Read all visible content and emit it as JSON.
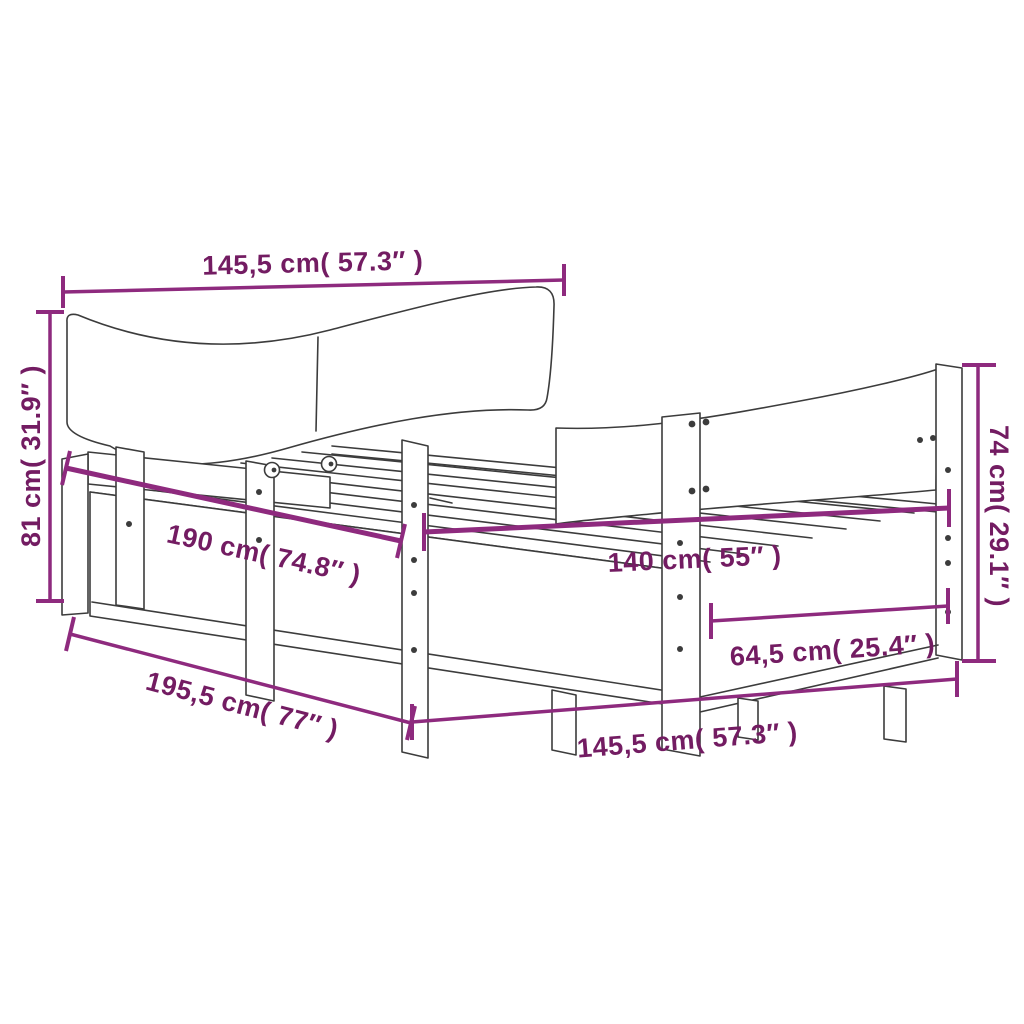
{
  "figure": {
    "title": "Bed frame with curved headboard and footboard - dimension diagram"
  },
  "colors": {
    "dimension_line": "#8E2A7E",
    "dimension_text": "#731C62",
    "drawing_line": "#3C3C3C",
    "background": "#FFFFFF"
  },
  "dimensions": {
    "headboard_width_top": {
      "label": "145,5 cm( 57.3″ )",
      "cm": "145,5",
      "inches": "57.3″"
    },
    "headboard_height": {
      "label": "81 cm( 31.9″ )",
      "cm": "81",
      "inches": "31.9″"
    },
    "bed_length_inner": {
      "label": "190 cm( 74.8″ )",
      "cm": "190",
      "inches": "74.8″"
    },
    "bed_width_inner": {
      "label": "140 cm( 55″ )",
      "cm": "140",
      "inches": "55″"
    },
    "foot_section_width": {
      "label": "64,5 cm( 25.4″ )",
      "cm": "64,5",
      "inches": "25.4″"
    },
    "footboard_height": {
      "label": "74 cm( 29.1″ )",
      "cm": "74",
      "inches": "29.1″"
    },
    "total_length": {
      "label": "195,5 cm( 77″ )",
      "cm": "195,5",
      "inches": "77″"
    },
    "frame_width_bottom": {
      "label": "145,5 cm( 57.3″ )",
      "cm": "145,5",
      "inches": "57.3″"
    }
  }
}
